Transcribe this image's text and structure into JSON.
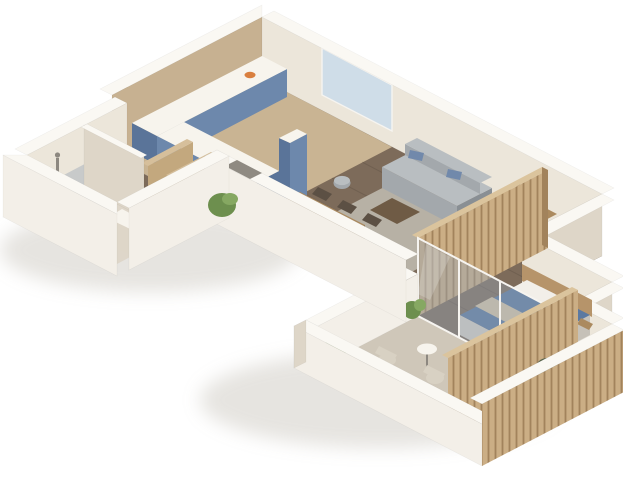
{
  "scene": {
    "description": "3D isometric render of an L-shaped one-bedroom apartment floor plan, viewed from above on a plain white background",
    "background": "#ffffff"
  },
  "palette": {
    "wall_white": "#f3efe8",
    "wall_top": "#faf8f3",
    "wall_cream": "#ece6da",
    "wall_shade": "#ded6c8",
    "wall_tan": "#c7b191",
    "notch_gray": "#8f8a82",
    "floor_dark": "#7d6b5a",
    "floor_light": "#c9b493",
    "floor_tile": "#ded6c9",
    "floor_balcony": "#cfc7b9",
    "floor_niche": "#c3bbad",
    "rug": "#b7b1a5",
    "kitchen_blue": "#6d88ac",
    "kitchen_blue_dark": "#5a7499",
    "counter_white": "#f7f4ed",
    "slat_wood": "#cbae85",
    "slat_light": "#dbc49d",
    "slat_dark": "#a2835c",
    "wardrobe_tan": "#c3a87e",
    "wardrobe_tan_light": "#d6bf9b",
    "glass": "rgba(150,165,180,0.42)",
    "glass_streak": "rgba(255,255,255,0.20)",
    "glass_frame": "#f6f4f0",
    "window_glass": "#cfdde8",
    "sofa": "#a3a8ac",
    "sofa_light": "#b9bec1",
    "sofa_dark": "#898f94",
    "pillow_blue": "#7189ab",
    "wood_furn": "#ab8a5f",
    "wood_furn_dark": "#8c6f49",
    "coffee_table": "#6f5b45",
    "chair_dark": "#5c5044",
    "bed_blue": "#5b79a1",
    "bed_side": "#d7d2c9",
    "bed_side_dark": "#c6c1b8",
    "pillow_white": "#f2efe9",
    "throw_beige": "#d8c6a7",
    "headboard": "#b6946a",
    "plant_green": "#6d8f4e",
    "plant_light": "#86a862",
    "plant_dark": "#55624a",
    "balcony_chair": "#d8d1c3",
    "metal_gray": "#8d8880",
    "fruit_orange": "#d97f3f",
    "shadow": "rgba(130,120,100,0.20)"
  },
  "objects": [
    "kitchen-cabinets-blue",
    "kitchen-countertop",
    "fruit-bowl",
    "hallway-wardrobe",
    "indoor-plant",
    "shower-enclosure",
    "washbasin",
    "toilet",
    "sofa",
    "blue-cushions",
    "pouf",
    "coffee-table",
    "area-rug",
    "dining-table",
    "dining-chairs",
    "desk",
    "monitor",
    "desk-chair",
    "wood-slat-partition",
    "double-bed",
    "pillows",
    "bed-throw",
    "headboard",
    "glass-sliding-wall",
    "balcony-table",
    "balcony-chairs",
    "balcony-plants",
    "wood-slat-screen",
    "niche-plant"
  ]
}
